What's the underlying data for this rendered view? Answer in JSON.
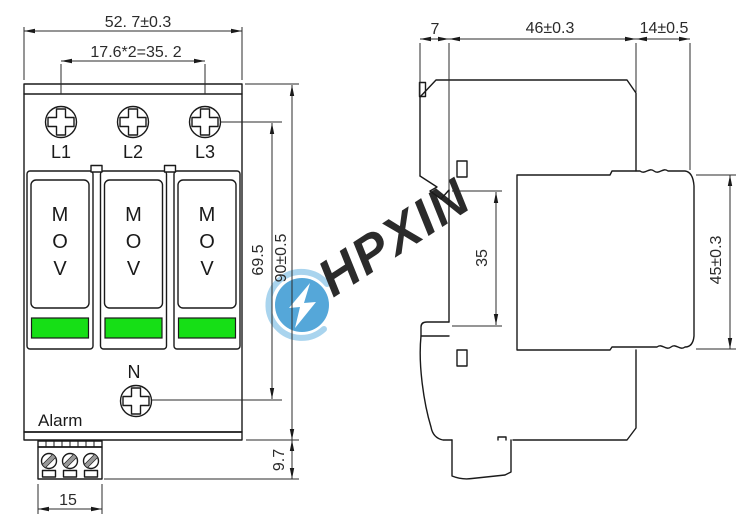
{
  "drawing": {
    "type": "dimension-drawing",
    "product": "surge-protective-device"
  },
  "colors": {
    "background": "#ffffff",
    "line": "#1a1a1a",
    "dim_text": "#2b2b2b",
    "indicator_green": "#16df16",
    "watermark_disc": "#55a7d9",
    "watermark_text": "#b7dbf2",
    "watermark_swoosh": "#a9d4ee"
  },
  "front_view": {
    "terminals": [
      "L1",
      "L2",
      "L3"
    ],
    "neutral_label": "N",
    "alarm_label": "Alarm",
    "module_letters": [
      "M",
      "O",
      "V"
    ],
    "dimensions": {
      "overall_width": "52. 7±0.3",
      "terminal_pitch": "17.6*2=35. 2",
      "screw_span": "69.5",
      "overall_height": "90±0.5",
      "terminal_depth": "9.7",
      "terminal_block_width": "15"
    }
  },
  "side_view": {
    "dimensions": {
      "clip_offset": "7",
      "base_depth": "46±0.3",
      "module_depth": "14±0.5",
      "din_rail_height": "35",
      "module_height": "45±0.3"
    }
  },
  "watermark": {
    "text": "HPXIN"
  }
}
